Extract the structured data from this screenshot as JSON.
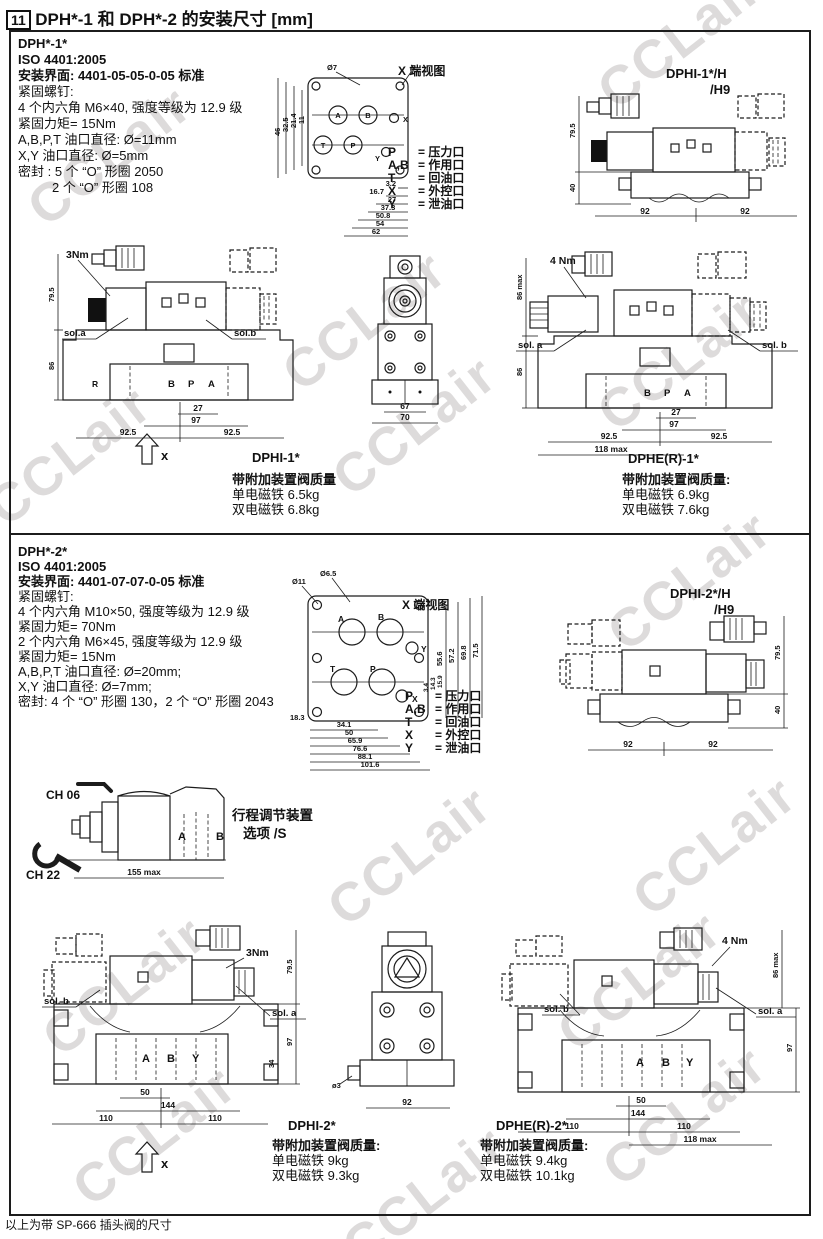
{
  "page": {
    "section_number": "11",
    "title": "DPH*-1 和 DPH*-2 的安装尺寸 [mm]",
    "footer_note": "以上为带 SP-666 插头阀的尺寸",
    "watermark_text": "CCLair"
  },
  "port_legend": {
    "view_label": "X 端视图",
    "rows": [
      {
        "sym": "P",
        "desc": "= 压力口"
      },
      {
        "sym": "A,B",
        "desc": "= 作用口"
      },
      {
        "sym": "T",
        "desc": "= 回油口"
      },
      {
        "sym": "X",
        "desc": "= 外控口"
      },
      {
        "sym": "Y",
        "desc": "= 泄油口"
      }
    ]
  },
  "sec1": {
    "model": "DPH*-1*",
    "iso": "ISO 4401:2005",
    "mount": "安装界面: 4401-05-05-0-05 标准",
    "lines": [
      "紧固螺钉:",
      "4 个内六角 M6×40, 强度等级为 12.9 级",
      "紧固力矩= 15Nm",
      "A,B,P,T 油口直径: Ø=11mm",
      "X,Y 油口直径: Ø=5mm",
      "密封 : 5 个 “O” 形圈 2050",
      "2 个 “O” 形圈 108"
    ],
    "face": {
      "dia": "Ø7",
      "top_dim": "5",
      "left_dims": [
        "46",
        "32.5",
        "21.4",
        "11"
      ],
      "bottom_dims": [
        "3.2",
        "16.7",
        "27",
        "37.3",
        "50.8",
        "54",
        "62"
      ],
      "ports": {
        "p": "P",
        "a": "A",
        "b": "B",
        "t": "T",
        "x": "X",
        "y": "Y"
      }
    },
    "h9": {
      "line1": "DPHI-1*/H",
      "line2": "/H9",
      "h": "79.5",
      "h2": "40",
      "w1": "92",
      "w2": "92"
    },
    "front": {
      "label": "DPHI-1*",
      "torque": "3Nm",
      "sol_a": "sol.a",
      "sol_b": "sol.b",
      "h1": "79.5",
      "h2": "86",
      "d27": "27",
      "d97": "97",
      "d925a": "92.5",
      "d925b": "92.5",
      "pb": "B",
      "pp": "P",
      "pa": "A",
      "pr": "R",
      "x_label": "x"
    },
    "end": {
      "d1": "67",
      "d2": "70"
    },
    "dphe": {
      "label": "DPHE(R)-1*",
      "torque": "4 Nm",
      "sol_a": "sol. a",
      "sol_b": "sol. b",
      "h1": "86 max",
      "h2": "86",
      "d27": "27",
      "d97": "97",
      "d925a": "92.5",
      "d925b": "92.5",
      "dmax": "118 max",
      "pb": "B",
      "pp": "P",
      "pa": "A"
    },
    "w_dphi": {
      "title": "带附加装置阀质量",
      "single": "单电磁铁 6.5kg",
      "double": "双电磁铁 6.8kg"
    },
    "w_dphe": {
      "title": "带附加装置阀质量:",
      "single": "单电磁铁 6.9kg",
      "double": "双电磁铁 7.6kg"
    }
  },
  "sec2": {
    "model": "DPH*-2*",
    "iso": "ISO 4401:2005",
    "mount": "安装界面: 4401-07-07-0-05 标准",
    "lines": [
      "紧固螺钉:",
      "4 个内六角 M10×50, 强度等级为 12.9 级",
      "紧固力矩= 70Nm",
      "2 个内六角 M6×45, 强度等级为 12.9 级",
      "紧固力矩= 15Nm",
      "A,B,P,T 油口直径: Ø=20mm;",
      "X,Y 油口直径: Ø=7mm;",
      "密封: 4 个 “O” 形圈 130，2 个 “O” 形圈 2043"
    ],
    "face": {
      "dia1": "Ø11",
      "dia2": "Ø6.5",
      "left_dim": "18.3",
      "right_dims": [
        "55.6",
        "57.2",
        "69.8",
        "71.5"
      ],
      "small_dims": [
        "3.4",
        "14.3",
        "15.9"
      ],
      "bottom_dims": [
        "34.1",
        "50",
        "65.9",
        "76.6",
        "88.1",
        "101.6"
      ],
      "ports": {
        "p": "P",
        "a": "A",
        "b": "B",
        "t": "T",
        "x": "X",
        "y": "Y"
      }
    },
    "h9": {
      "line1": "DPHI-2*/H",
      "line2": "/H9",
      "h": "79.5",
      "h2": "40",
      "w1": "92",
      "w2": "92"
    },
    "stroke": {
      "ch1": "CH 06",
      "ch2": "CH 22",
      "dim": "155 max",
      "t1": "行程调节装置",
      "t2": "选项 /S",
      "pa": "A",
      "pb": "B"
    },
    "front": {
      "label": "DPHI-2*",
      "torque": "3Nm",
      "sol_a": "sol. a",
      "sol_b": "sol. b",
      "h1": "79.5",
      "h2": "97",
      "h3": "34",
      "d50": "50",
      "d144": "144",
      "d110a": "110",
      "d110b": "110",
      "pa": "A",
      "pb": "B",
      "py": "Y",
      "x_label": "x"
    },
    "end": {
      "d1": "92",
      "d2": "ø3"
    },
    "dphe": {
      "label": "DPHE(R)-2*",
      "torque": "4 Nm",
      "sol_a": "sol. a",
      "sol_b": "sol. b",
      "h1": "86 max",
      "h2": "97",
      "d50": "50",
      "d144": "144",
      "d110a": "110",
      "d110b": "110",
      "dmax": "118 max",
      "pa": "A",
      "pb": "B",
      "py": "Y"
    },
    "w_dphi": {
      "title": "带附加装置阀质量:",
      "single": "单电磁铁 9kg",
      "double": "双电磁铁 9.3kg"
    },
    "w_dphe": {
      "title": "带附加装置阀质量:",
      "single": "单电磁铁 9.4kg",
      "double": "双电磁铁 10.1kg"
    }
  }
}
